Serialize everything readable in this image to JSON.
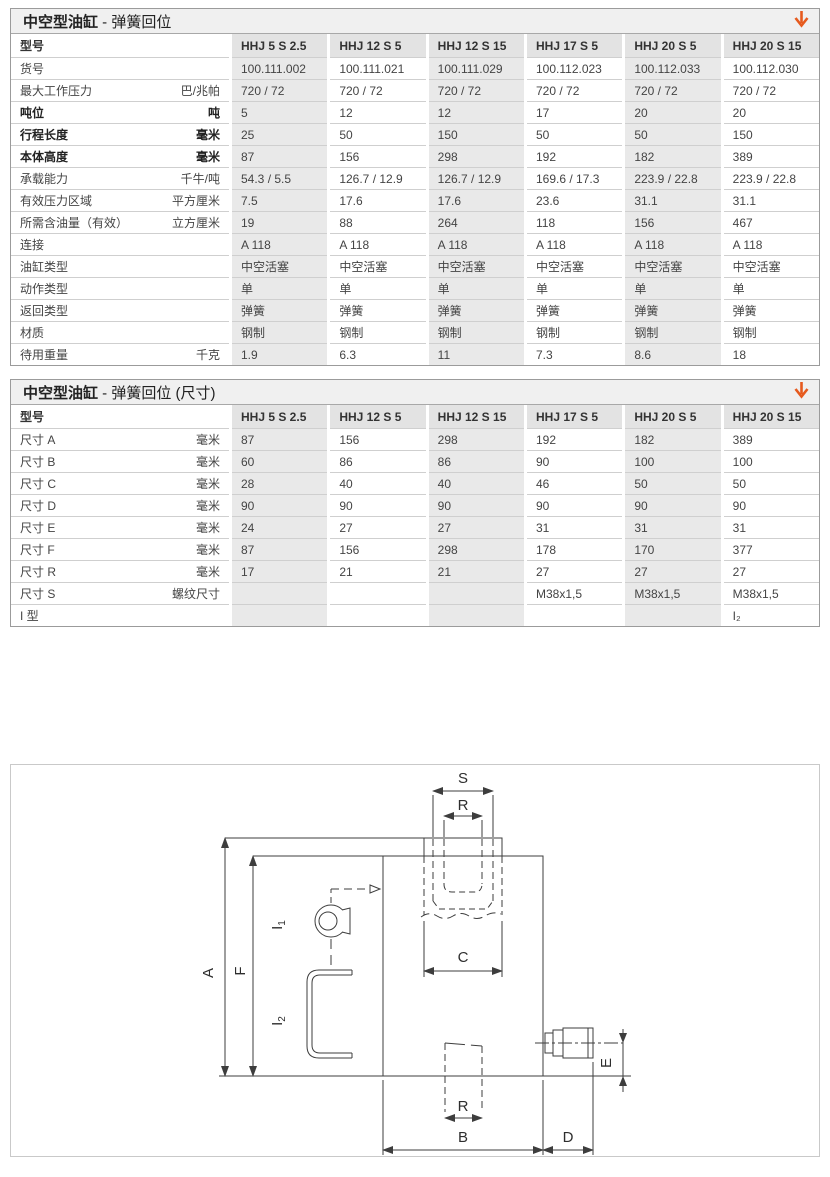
{
  "table1": {
    "title_bold": "中空型油缸",
    "title_rest": " - 弹簧回位",
    "row_header_label": "型号",
    "columns": [
      "HHJ 5 S 2.5",
      "HHJ 12 S 5",
      "HHJ 12 S 15",
      "HHJ 17 S 5",
      "HHJ 20 S 5",
      "HHJ 20 S 15"
    ],
    "rows": [
      {
        "label": "货号",
        "unit": "",
        "bold": false,
        "values": [
          "100.111.002",
          "100.111.021",
          "100.111.029",
          "100.112.023",
          "100.112.033",
          "100.112.030"
        ]
      },
      {
        "label": "最大工作压力",
        "unit": "巴/兆帕",
        "bold": false,
        "values": [
          "720 / 72",
          "720 / 72",
          "720 / 72",
          "720 / 72",
          "720 / 72",
          "720 / 72"
        ]
      },
      {
        "label": "吨位",
        "unit": "吨",
        "bold": true,
        "values": [
          "5",
          "12",
          "12",
          "17",
          "20",
          "20"
        ]
      },
      {
        "label": "行程长度",
        "unit": "毫米",
        "bold": true,
        "values": [
          "25",
          "50",
          "150",
          "50",
          "50",
          "150"
        ]
      },
      {
        "label": "本体高度",
        "unit": "毫米",
        "bold": true,
        "values": [
          "87",
          "156",
          "298",
          "192",
          "182",
          "389"
        ]
      },
      {
        "label": "承载能力",
        "unit": "千牛/吨",
        "bold": false,
        "values": [
          "54.3 / 5.5",
          "126.7 / 12.9",
          "126.7 / 12.9",
          "169.6 / 17.3",
          "223.9 / 22.8",
          "223.9 / 22.8"
        ]
      },
      {
        "label": "有效压力区域",
        "unit": "平方厘米",
        "bold": false,
        "values": [
          "7.5",
          "17.6",
          "17.6",
          "23.6",
          "31.1",
          "31.1"
        ]
      },
      {
        "label": "所需含油量（有效）",
        "unit": "立方厘米",
        "bold": false,
        "values": [
          "19",
          "88",
          "264",
          "118",
          "156",
          "467"
        ]
      },
      {
        "label": "连接",
        "unit": "",
        "bold": false,
        "values": [
          "A 118",
          "A 118",
          "A 118",
          "A 118",
          "A 118",
          "A 118"
        ]
      },
      {
        "label": "油缸类型",
        "unit": "",
        "bold": false,
        "values": [
          "中空活塞",
          "中空活塞",
          "中空活塞",
          "中空活塞",
          "中空活塞",
          "中空活塞"
        ]
      },
      {
        "label": "动作类型",
        "unit": "",
        "bold": false,
        "values": [
          "单",
          "单",
          "单",
          "单",
          "单",
          "单"
        ]
      },
      {
        "label": "返回类型",
        "unit": "",
        "bold": false,
        "values": [
          "弹簧",
          "弹簧",
          "弹簧",
          "弹簧",
          "弹簧",
          "弹簧"
        ]
      },
      {
        "label": "材质",
        "unit": "",
        "bold": false,
        "values": [
          "钢制",
          "钢制",
          "钢制",
          "钢制",
          "钢制",
          "钢制"
        ]
      },
      {
        "label": "待用重量",
        "unit": "千克",
        "bold": false,
        "values": [
          "1.9",
          "6.3",
          "11",
          "7.3",
          "8.6",
          "18"
        ]
      }
    ]
  },
  "table2": {
    "title_bold": "中空型油缸",
    "title_rest": " - 弹簧回位 (尺寸)",
    "row_header_label": "型号",
    "columns": [
      "HHJ 5 S 2.5",
      "HHJ 12 S 5",
      "HHJ 12 S 15",
      "HHJ 17 S 5",
      "HHJ 20 S 5",
      "HHJ 20 S 15"
    ],
    "rows": [
      {
        "label": "尺寸 A",
        "unit": "毫米",
        "bold": false,
        "values": [
          "87",
          "156",
          "298",
          "192",
          "182",
          "389"
        ]
      },
      {
        "label": "尺寸 B",
        "unit": "毫米",
        "bold": false,
        "values": [
          "60",
          "86",
          "86",
          "90",
          "100",
          "100"
        ]
      },
      {
        "label": "尺寸 C",
        "unit": "毫米",
        "bold": false,
        "values": [
          "28",
          "40",
          "40",
          "46",
          "50",
          "50"
        ]
      },
      {
        "label": "尺寸 D",
        "unit": "毫米",
        "bold": false,
        "values": [
          "90",
          "90",
          "90",
          "90",
          "90",
          "90"
        ]
      },
      {
        "label": "尺寸 E",
        "unit": "毫米",
        "bold": false,
        "values": [
          "24",
          "27",
          "27",
          "31",
          "31",
          "31"
        ]
      },
      {
        "label": "尺寸 F",
        "unit": "毫米",
        "bold": false,
        "values": [
          "87",
          "156",
          "298",
          "178",
          "170",
          "377"
        ]
      },
      {
        "label": "尺寸 R",
        "unit": "毫米",
        "bold": false,
        "values": [
          "17",
          "21",
          "21",
          "27",
          "27",
          "27"
        ]
      },
      {
        "label": "尺寸 S",
        "unit": "螺纹尺寸",
        "bold": false,
        "values": [
          "",
          "",
          "",
          "M38x1,5",
          "M38x1,5",
          "M38x1,5"
        ]
      },
      {
        "label": "I 型",
        "unit": "",
        "bold": false,
        "values": [
          "",
          "",
          "",
          "",
          "",
          "I₂"
        ]
      }
    ]
  },
  "icons": {
    "download_arrow_color": "#E65A1E"
  },
  "diagram": {
    "labels": {
      "s": "S",
      "r_top": "R",
      "c": "C",
      "r_bottom": "R",
      "b": "B",
      "d": "D",
      "a": "A",
      "f": "F",
      "e": "E",
      "i1_base": "I",
      "i1_sub": "1",
      "i2_base": "I",
      "i2_sub": "2"
    }
  }
}
